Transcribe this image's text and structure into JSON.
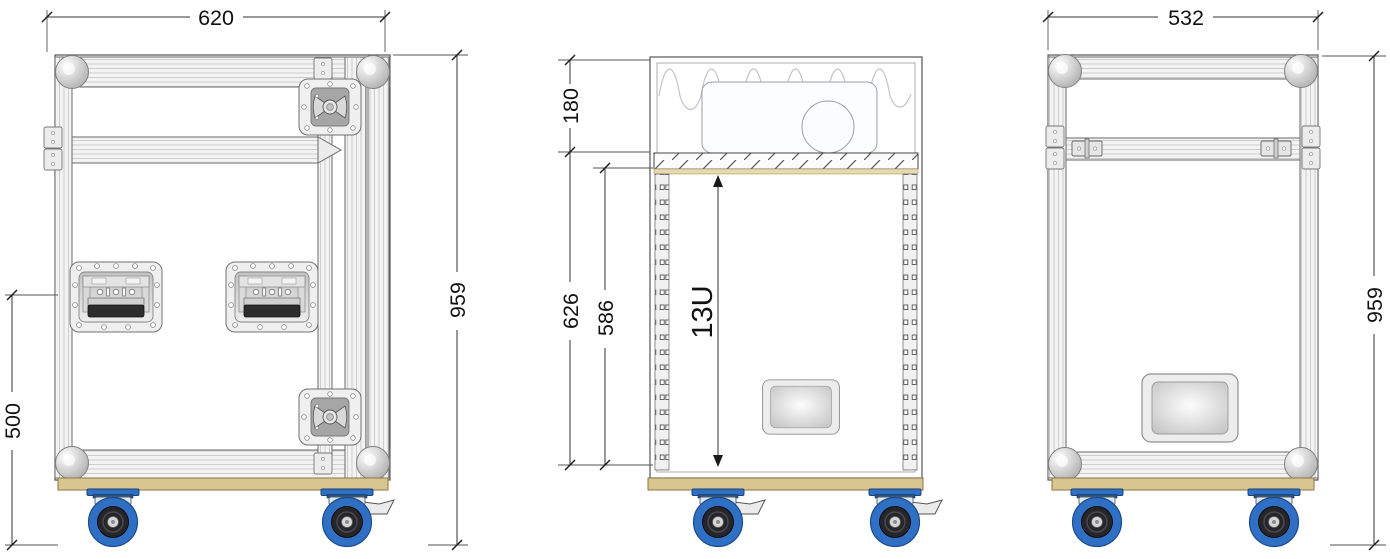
{
  "drawing": {
    "title": "Flight case wheeled rack — three-view technical drawing",
    "views": {
      "front": {
        "dims": {
          "width": "620",
          "height": "959",
          "handle_height": "500"
        }
      },
      "section": {
        "dims": {
          "lid_depth": "180",
          "interior_height": "626",
          "rack_opening": "586",
          "rack_units": "13U"
        }
      },
      "rear": {
        "dims": {
          "width": "532",
          "height": "959"
        }
      }
    },
    "chart_data": {
      "type": "table",
      "title": "Case dimensions (mm)",
      "categories": [
        "outer width front",
        "outer width side",
        "total height with castors",
        "lid depth",
        "interior height",
        "rack opening",
        "rack capacity",
        "handle height"
      ],
      "values": [
        620,
        532,
        959,
        180,
        626,
        586,
        "13U",
        500
      ]
    },
    "colors": {
      "line": "#444444",
      "dimension": "#1a1a1a",
      "wood": "#d9c58f",
      "wood_edge": "#8a7845",
      "caster_blue": "#2f6fc4",
      "caster_blue_dark": "#1c4884",
      "tire_hub": "#26262a",
      "metal_light": "#f1f1f1",
      "foam": "#c4c4cc"
    }
  }
}
